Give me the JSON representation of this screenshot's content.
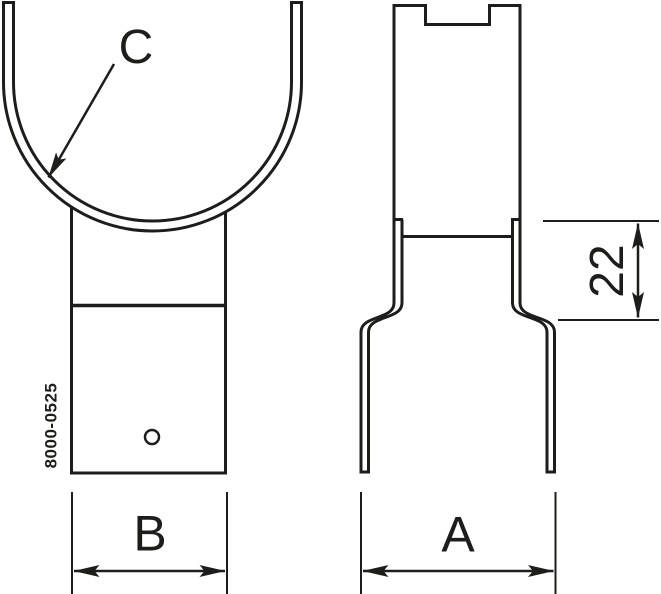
{
  "colors": {
    "ink": "#1d1d1b",
    "background": "#ffffff"
  },
  "front_view": {
    "saddle_label": "C",
    "part_number": "8000-0525",
    "width_dim_label": "B"
  },
  "side_view": {
    "width_dim_label": "A",
    "offset_dim_label": "22"
  }
}
